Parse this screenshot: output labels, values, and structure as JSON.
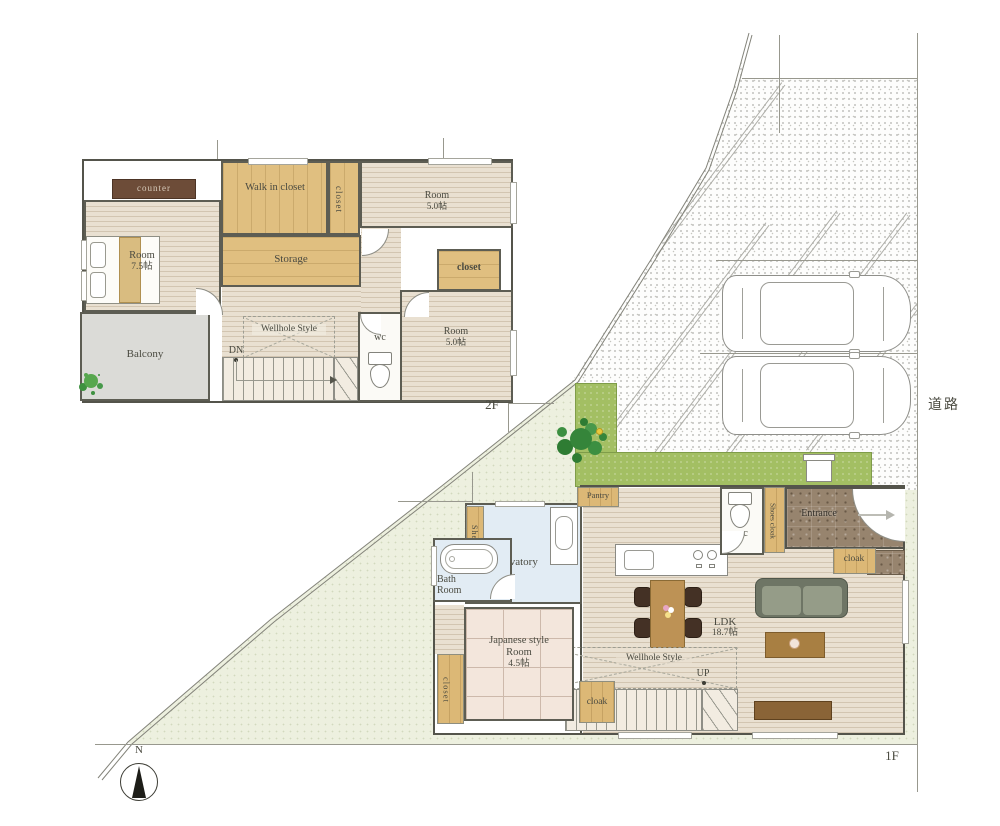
{
  "site": {
    "road_label": "道路",
    "floor2_tag": "2F",
    "floor1_tag": "1F",
    "compass_n": "N"
  },
  "palette": {
    "lot_green": "#edf0df",
    "garden_green": "#a3bf63",
    "wood_tan": "#dcb876",
    "bath_blue": "#e2ecf4",
    "tatami_pink": "#f3e6dc",
    "entrance_stone": "#97846e",
    "balcony_gray": "#dbdbd7"
  },
  "icons": {
    "compass": "compass-icon",
    "tree": "tree-icon",
    "plant": "plant-icon",
    "car": "car-icon",
    "toilet": "toilet-icon",
    "bathtub": "bathtub-icon",
    "washbasin": "washbasin-icon",
    "kitchen_sink": "sink-icon",
    "stove": "stove-icon",
    "bed": "bed-icon",
    "sofa": "sofa-icon",
    "dining_table": "dining-table-icon",
    "entrance_arrow": "entrance-arrow-icon"
  },
  "floor2": {
    "counter_label": "counter",
    "walk_in_closet": "Walk in closet",
    "closet_top": "closet",
    "room_ne_name": "Room",
    "room_ne_size": "5.0帖",
    "storage": "Storage",
    "room_w_name": "Room",
    "room_w_size": "7.5帖",
    "closet_mid": "closet",
    "balcony": "Balcony",
    "wellhole": "Wellhole Style",
    "dn_label": "DN",
    "wc_label": "wc",
    "room_se_name": "Room",
    "room_se_size": "5.0帖"
  },
  "floor1": {
    "pantry": "Pantry",
    "shelf": "Shelf",
    "lavatory": "Lavatory",
    "bath_room": "Bath Room",
    "wc_label": "wc",
    "shoes_cloak": "Shoes cloak",
    "entrance": "Entrance",
    "cloak_east": "cloak",
    "ldk_name": "LDK",
    "ldk_size": "18.7帖",
    "wellhole": "Wellhole Style",
    "up_label": "UP",
    "cloak_south": "cloak",
    "japanese_room_name": "Japanese style Room",
    "japanese_room_size": "4.5帖",
    "closet_west": "closet"
  }
}
